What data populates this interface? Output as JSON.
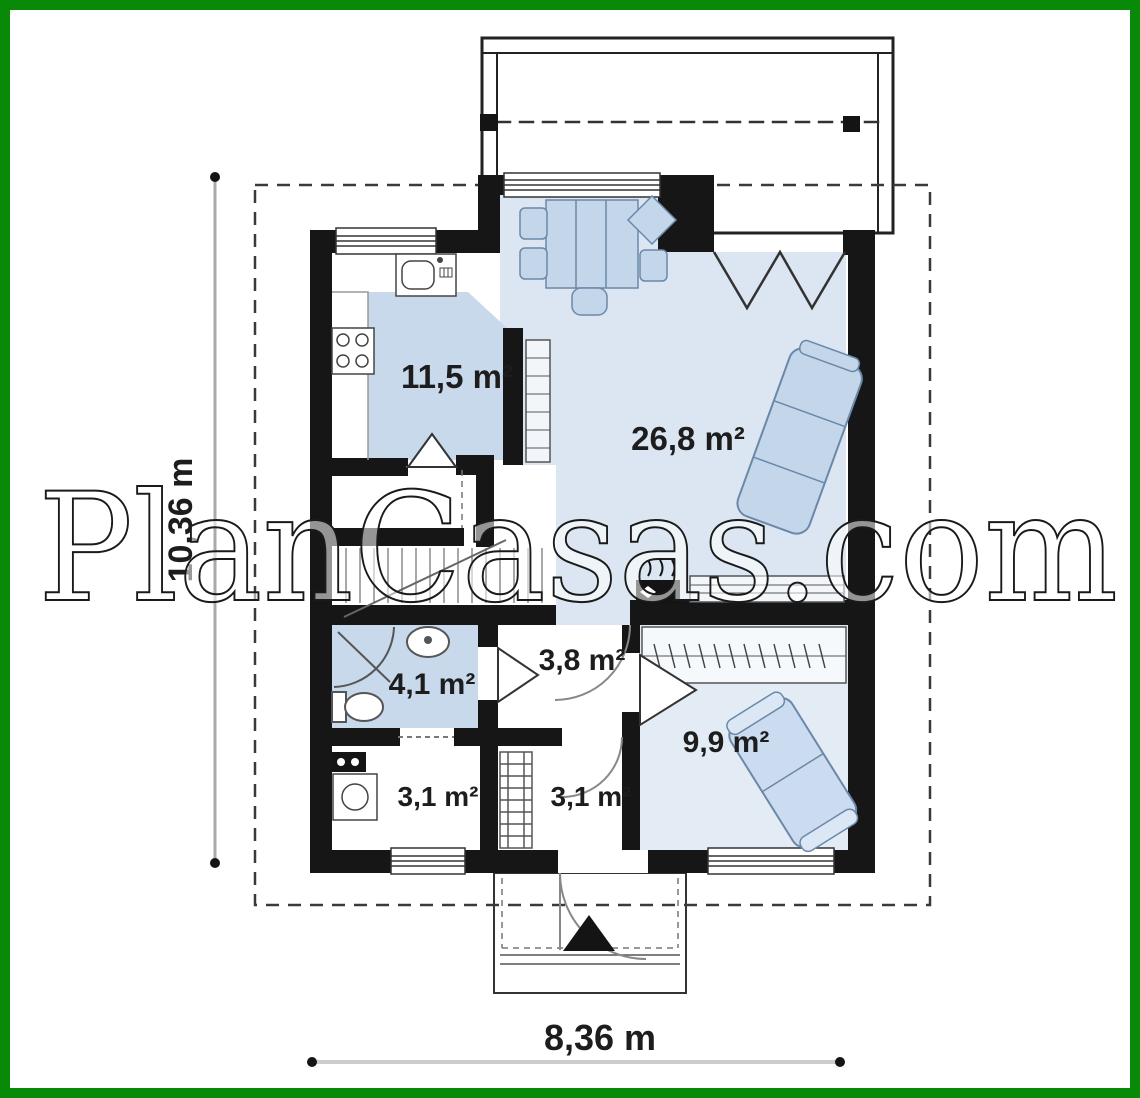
{
  "document": {
    "type": "house-floor-plan"
  },
  "frame": {
    "color": "#088A08"
  },
  "watermark": {
    "text": "PlanCasas.com"
  },
  "rooms": {
    "kitchen": {
      "area": "11,5 m²"
    },
    "living": {
      "area": "26,8 m²"
    },
    "bathroom": {
      "area": "4,1 m²"
    },
    "hall": {
      "area": "3,8 m²"
    },
    "bedroom": {
      "area": "9,9 m²"
    },
    "utility": {
      "area": "3,1 m²"
    },
    "vestibule": {
      "area": "3,1 m²"
    }
  },
  "dimensions": {
    "total_height": "10,36 m",
    "total_width": "8,36 m"
  },
  "colors": {
    "wall": "#161616",
    "room_blue": "#c8d9ec",
    "living_blue": "#dbe6f2",
    "bedroom_blue": "#e3ebf4",
    "furniture_fill": "#c3d6ea",
    "furniture_stroke": "#6b88a8",
    "label": "#1d1d1d",
    "frame_green": "#088A08",
    "watermark_fill": "rgba(255,255,255,0.55)",
    "watermark_stroke": "#1a1a1a"
  }
}
